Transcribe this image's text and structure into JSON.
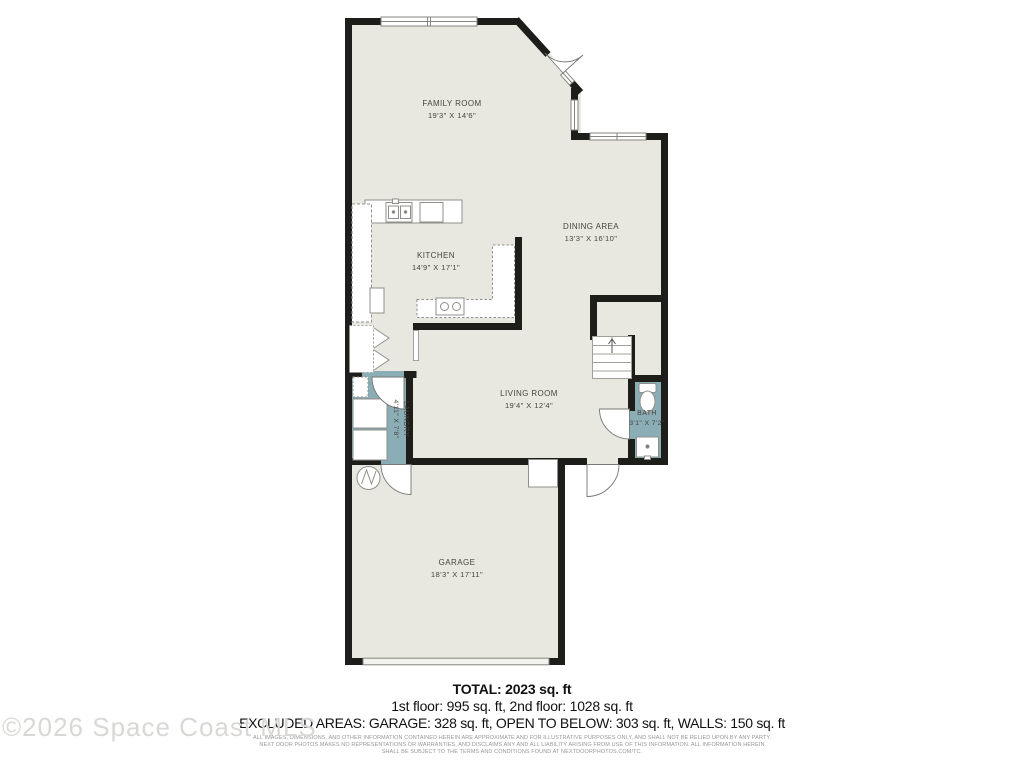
{
  "watermark": "©2026 Space Coast MLS",
  "rooms": {
    "family": {
      "name": "FAMILY ROOM",
      "dims": "19'3\" X 14'6\""
    },
    "kitchen": {
      "name": "KITCHEN",
      "dims": "14'9\" X 17'1\""
    },
    "dining": {
      "name": "DINING AREA",
      "dims": "13'3\" X 16'10\""
    },
    "living": {
      "name": "LIVING ROOM",
      "dims": "19'4\" X 12'4\""
    },
    "laundry": {
      "name": "LAUNDRY",
      "dims": "4'11\" X 7'8\""
    },
    "bath": {
      "name": "BATH",
      "dims": "3'1\" X 7'2\""
    },
    "garage": {
      "name": "GARAGE",
      "dims": "18'3\" X 17'11\""
    }
  },
  "footer": {
    "total": "TOTAL: 2023 sq. ft",
    "floors": "1st floor: 995 sq. ft, 2nd floor: 1028 sq. ft",
    "excluded": "EXCLUDED AREAS: GARAGE: 328 sq. ft, OPEN TO BELOW: 303 sq. ft, WALLS: 150 sq. ft",
    "disclaimer_line1": "ALL IMAGES, DIMENSIONS, AND OTHER INFORMATION CONTAINED HEREIN ARE APPROXIMATE AND FOR ILLUSTRATIVE PURPOSES ONLY, AND SHALL NOT BE RELIED UPON BY ANY PARTY.",
    "disclaimer_line2": "NEXT DOOR PHOTOS MAKES NO REPRESENTATIONS OR WARRANTIES, AND DISCLAIMS ANY AND ALL LIABILITY ARISING FROM USE OF THIS INFORMATION. ALL INFORMATION HEREIN",
    "disclaimer_line3": "SHALL BE SUBJECT TO THE TERMS AND CONDITIONS FOUND AT NEXTDOORPHOTOS.COM/TC."
  },
  "colors": {
    "wall": "#1d1d1a",
    "room_fill": "#e9e8e0",
    "wet_room_fill": "#8badb5",
    "fixture_stroke": "#8f8f8b"
  }
}
